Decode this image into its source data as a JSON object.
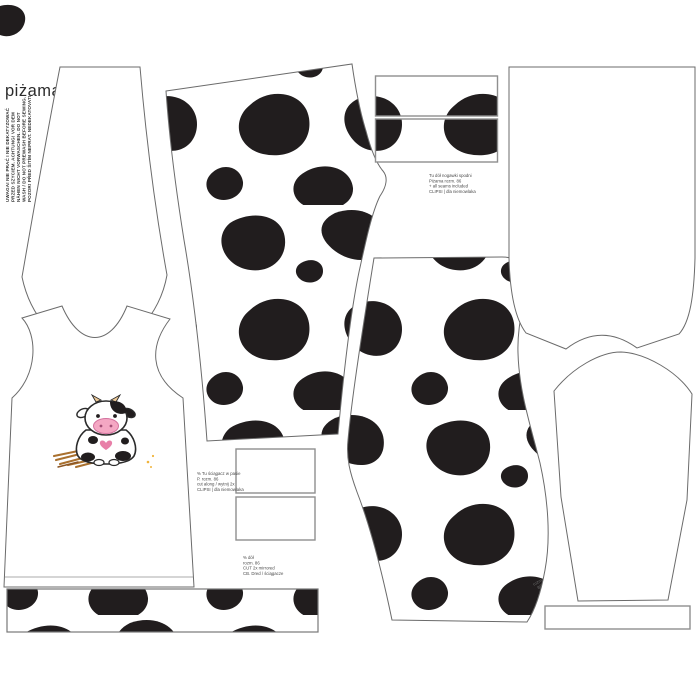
{
  "title": {
    "label": "piżama"
  },
  "care_warning": {
    "lines": [
      "UWAGA! NIE PRAĆ I NIE DEKATYZOWAĆ",
      "PRZED SZYCIEM. ACHTUNG! VOR DEM",
      "NÄHEN NICHT VORWASCHEN. DO NOT",
      "WASH / DO NOT PREWASH BEFORE SEWING.",
      "POZOR! PŘED ŠITÍM NEPRAT. NEDEKATOVAT!"
    ]
  },
  "small_print": {
    "pant_label": {
      "lines": [
        "Tu dół nogawki spodni",
        "Piżama  rozm. 86",
        "+ all seams included",
        "CLIPSI | dla niemowlaka"
      ]
    },
    "waistband_label": {
      "lines": [
        "% Tu ściągacz w pasie",
        "P. rozm. 86",
        "cut along / wytnij 2x",
        "CLIPSI | dla niemowlaka"
      ]
    },
    "cuff_label": {
      "lines": [
        "% dół",
        "rozm. 86",
        "CUT 2x mirrored",
        "CB. Dred / ściągacze"
      ]
    },
    "size_note": {
      "lines": [
        "rozm.",
        "86"
      ]
    }
  },
  "colors": {
    "spot_black": "#211d1e",
    "piece_outline": "#6b6b6b",
    "strip_border": "#8f8f8f",
    "title_text": "#2b2b2b",
    "small_print_text": "#4a4a4a",
    "hay_brown": "#a9702e",
    "muzzle_pink": "#f4a7c3",
    "heart_pink": "#e87fa8",
    "horn_cream": "#ecc897",
    "speck_orange": "#f0b43c"
  }
}
